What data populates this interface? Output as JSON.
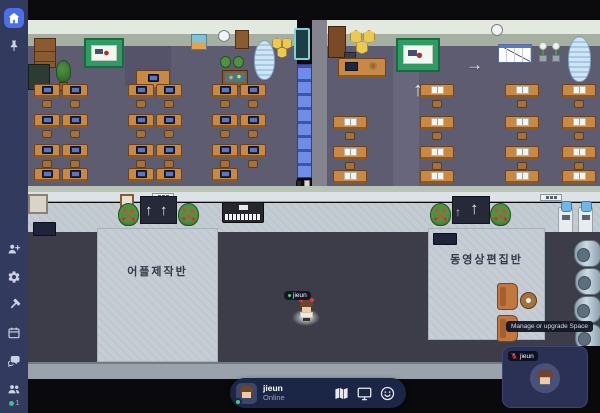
{
  "sidebar": {
    "icons": [
      "home",
      "pin",
      "add-member",
      "settings",
      "build",
      "calendar",
      "chat",
      "members"
    ],
    "members_count": "1"
  },
  "map": {
    "left_room_label": "어플제작반",
    "right_room_label": "동영상편집반",
    "player_tag": "jieun"
  },
  "tooltip_text": "Manage or upgrade Space",
  "bottom_bar": {
    "player_name": "jieun",
    "player_status": "Online",
    "icons": [
      "map",
      "screen-share",
      "emote"
    ]
  },
  "video_tile": {
    "player_name": "jieun",
    "mic_muted": true
  },
  "colors": {
    "accent_blue": "#4a6fe9",
    "online_green": "#3bd47e",
    "mic_muted_red": "#ff5252",
    "sidebar_bg": "#323a5e",
    "bottom_bar_bg": "#1b2545"
  }
}
